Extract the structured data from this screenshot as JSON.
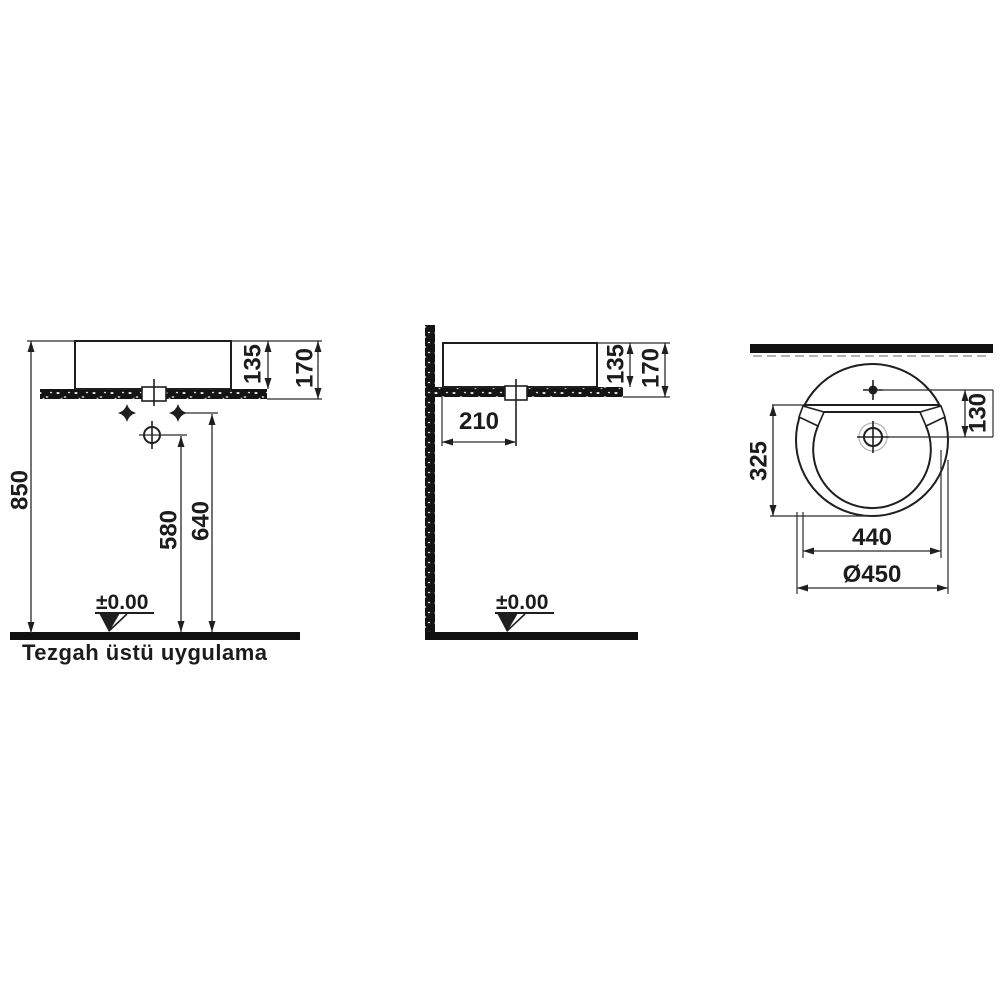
{
  "theme": {
    "background": "#ffffff",
    "ink": "#1c1c1c"
  },
  "caption": "Tezgah üstü uygulama",
  "front_view": {
    "dim_total_height": "850",
    "dim_faucet_height": "580",
    "dim_fixing_height": "640",
    "dim_rim_above_counter": "135",
    "dim_basin_height": "170",
    "level_label": "±0.00"
  },
  "side_view": {
    "dim_drain_offset": "210",
    "dim_rim_above_counter": "135",
    "dim_basin_height": "170",
    "level_label": "±0.00"
  },
  "top_view": {
    "dim_tap_to_drain": "130",
    "dim_bowl_depth": "325",
    "dim_bowl_width": "440",
    "dim_outer_diameter": "Ø450"
  }
}
